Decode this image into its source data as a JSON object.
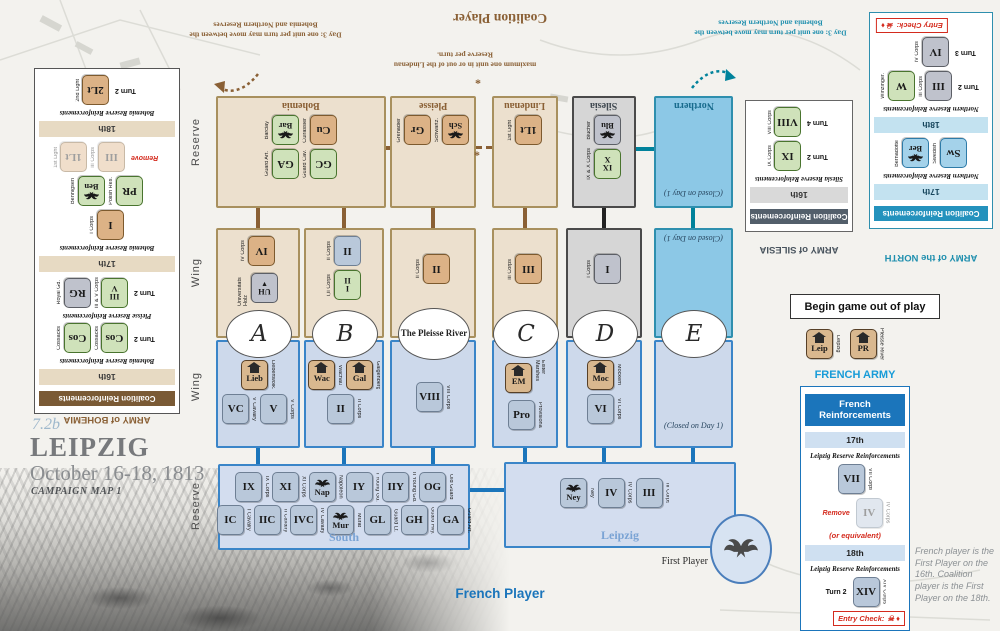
{
  "meta": {
    "code": "7.2b",
    "title": "LEIPZIG",
    "dates": "October 16-18, 1813",
    "subtitle": "CAMPAIGN MAP 1"
  },
  "players": {
    "coalition": "Coalition Player",
    "french": "French Player",
    "first": "First Player"
  },
  "notes": {
    "day3": "Day 3:  one unit per turn may move between the Bohemia and Northern Reserves",
    "lindenau_note": "maximum one unit in or out of the Lindenau Reserve per turn.",
    "asterisk": "*",
    "closed": "(Closed on Day 1)",
    "begin": "Begin game out of play",
    "first_player_note": "French player is the First Player on the 16th. Coalition player is the First Player on the 18th."
  },
  "side_labels": {
    "res_top": "Reserve",
    "wing_top": "Wing",
    "wing_bottom": "Wing",
    "res_bottom": "Reserve"
  },
  "board": {
    "titles": {
      "bohemia": "Bohemia",
      "pleisse": "Pleisse",
      "lindenau": "Lindenau",
      "silesia": "Silesia",
      "northern": "Northern"
    },
    "ovals": {
      "a": "A",
      "b": "B",
      "p": "The Pleisse River",
      "c": "C",
      "d": "D",
      "e": "E"
    },
    "south_label": "South",
    "leipzig_label": "Leipzig"
  },
  "rows": {
    "bohemia_r1": {
      "counters": [
        {
          "v": "Bar",
          "t": "green",
          "i": "eagle",
          "l": "Barclay"
        },
        {
          "v": "Cu",
          "t": "tan",
          "l": "Cuirassier"
        }
      ]
    },
    "bohemia_r2": {
      "counters": [
        {
          "v": "GA",
          "t": "green",
          "l": "Guard Art."
        },
        {
          "v": "GC",
          "t": "green",
          "l": "Guard Cav."
        }
      ]
    },
    "pleisse_r1": {
      "counters": [
        {
          "v": "Gr",
          "t": "tan",
          "l": "Grenadier"
        },
        {
          "v": "Sch",
          "t": "tan",
          "i": "eagle",
          "l": "Schwartz."
        }
      ]
    },
    "lindenau_r1": {
      "counters": [
        {
          "v": "1Lt",
          "t": "tan",
          "l": "1st Light"
        }
      ]
    },
    "silesia_r1": {
      "counters": [
        {
          "v": "Blu",
          "t": "gray",
          "i": "eagle",
          "l": "Blücher"
        },
        {
          "v": "IX|X",
          "t": "green",
          "l": "IX & X Corps"
        }
      ]
    },
    "cwA_r1": {
      "counters": [
        {
          "v": "IV",
          "t": "tan",
          "l": "IV Corps"
        }
      ]
    },
    "cwA_r2": {
      "counters": [
        {
          "v": "UH",
          "t": "gray",
          "i": "down",
          "l": "Universitäts Holz"
        }
      ]
    },
    "cwB_r1": {
      "counters": [
        {
          "v": "II",
          "t": "french",
          "l": "II Corps"
        }
      ]
    },
    "cwB_r2": {
      "counters": [
        {
          "v": "I|II",
          "t": "green",
          "l": "I,II Corps"
        }
      ]
    },
    "cwP_r1": {
      "counters": [
        {
          "v": "II",
          "t": "tan",
          "l": "II Corps"
        }
      ]
    },
    "cwC_r1": {
      "counters": [
        {
          "v": "III",
          "t": "tan",
          "l": "III Corps"
        }
      ]
    },
    "cwD_r1": {
      "counters": [
        {
          "v": "I",
          "t": "gray",
          "l": "I Corps"
        }
      ]
    },
    "fwA_r1": {
      "counters": [
        {
          "v": "Lieb",
          "t": "obj",
          "i": "house",
          "l": "Liebertwolk."
        }
      ]
    },
    "fwA_r2": {
      "counters": [
        {
          "v": "VC",
          "t": "french",
          "l": "V Cavalry"
        },
        {
          "v": "V",
          "t": "french",
          "l": "V Corps"
        }
      ]
    },
    "fwB_r1": {
      "counters": [
        {
          "v": "Wac",
          "t": "obj",
          "i": "house",
          "l": "Wachau"
        },
        {
          "v": "Gal",
          "t": "obj",
          "i": "house",
          "l": "Galgenberg"
        }
      ]
    },
    "fwB_r2": {
      "counters": [
        {
          "v": "II",
          "t": "french",
          "l": "II Corps"
        }
      ]
    },
    "fwP_r1": {
      "counters": [
        {
          "v": "VIII",
          "t": "french",
          "l": "VIII Corps"
        }
      ]
    },
    "fwC_r1": {
      "counters": [
        {
          "v": "EM",
          "t": "obj",
          "i": "house",
          "l": "Elster Marshes"
        }
      ]
    },
    "fwC_r2": {
      "counters": [
        {
          "v": "Pro",
          "t": "french",
          "l": "Provisional"
        }
      ]
    },
    "fwD_r1": {
      "counters": [
        {
          "v": "Moc",
          "t": "obj",
          "i": "house",
          "l": "Mockern"
        }
      ]
    },
    "fwD_r2": {
      "counters": [
        {
          "v": "VI",
          "t": "french",
          "l": "VI Corps"
        }
      ]
    },
    "south_r1": {
      "counters": [
        {
          "v": "IX",
          "t": "french",
          "l": "IX Corps"
        },
        {
          "v": "XI",
          "t": "french",
          "l": "XI Corps"
        },
        {
          "v": "Nap",
          "t": "french",
          "i": "eagle",
          "l": "Napoleon"
        },
        {
          "v": "IY",
          "t": "french",
          "l": "I Young Gd."
        },
        {
          "v": "IIY",
          "t": "french",
          "l": "II Young Gd."
        },
        {
          "v": "OG",
          "t": "french",
          "l": "Old Guard"
        }
      ]
    },
    "south_r2": {
      "counters": [
        {
          "v": "IC",
          "t": "french",
          "l": "I Cavalry"
        },
        {
          "v": "IIC",
          "t": "french",
          "l": "II Cavalry"
        },
        {
          "v": "IVC",
          "t": "french",
          "l": "IV Cavalry"
        },
        {
          "v": "Mur",
          "t": "french",
          "i": "eagle",
          "l": "Murat"
        },
        {
          "v": "GL",
          "t": "french",
          "l": "Guard Lt."
        },
        {
          "v": "GH",
          "t": "french",
          "l": "Guard Hvy."
        },
        {
          "v": "GA",
          "t": "french",
          "l": "Guard Art."
        }
      ]
    },
    "leipzig_r1": {
      "counters": [
        {
          "v": "Ney",
          "t": "french",
          "i": "eagle",
          "l": "Ney"
        },
        {
          "v": "IV",
          "t": "french",
          "l": "IV Corps"
        },
        {
          "v": "III",
          "t": "french",
          "l": "III Corps"
        }
      ]
    },
    "oop_r1": {
      "counters": [
        {
          "v": "Leip",
          "t": "obj",
          "i": "house",
          "l": "Leipzig"
        },
        {
          "v": "PR",
          "t": "obj",
          "i": "house",
          "l": "Pleisse River"
        }
      ]
    }
  },
  "bohemia_panel": {
    "title": "ARMY of BOHEMIA",
    "header": "Coalition Reinforcements",
    "b18": "18th",
    "b17": "17th",
    "b16": "16th",
    "lbl_b": "Bohemia Reserve Reinforcements",
    "lbl_p": "Pleisse Reserve Reinforcements",
    "r18": {
      "counters": [
        {
          "v": "2Lt",
          "t": "tan",
          "l": "2nd Light"
        }
      ],
      "post": "Turn 2"
    },
    "r17a": {
      "counters": [
        {
          "v": "1Lt",
          "t": "tan",
          "l": "1st Light",
          "faded": true
        },
        {
          "v": "III",
          "t": "tan",
          "l": "III Corps",
          "faded": true
        }
      ],
      "post": "Remove",
      "post_style": "red"
    },
    "r17b": {
      "counters": [
        {
          "v": "Ben",
          "t": "green",
          "i": "eagle",
          "l": "Bennigsen"
        },
        {
          "v": "PR",
          "t": "green",
          "l": "Polish Res."
        }
      ]
    },
    "r17c": {
      "counters": [
        {
          "v": "I",
          "t": "tan",
          "l": "I Corps"
        }
      ]
    },
    "r16p": {
      "counters": [
        {
          "v": "RG",
          "t": "gray",
          "l": "Royal Gd."
        },
        {
          "v": "III|V",
          "t": "green",
          "l": "III & V Corps"
        }
      ],
      "post": "Turn 2"
    },
    "r16b": {
      "counters": [
        {
          "v": "Cos",
          "t": "green",
          "l": "Cossacks"
        },
        {
          "v": "Cos",
          "t": "green",
          "l": "Cossacks"
        }
      ],
      "post": "Turn 2"
    }
  },
  "silesia_panel": {
    "title": "ARMY of SILESIA",
    "header": "Coalition Reinforcements",
    "b16": "16th",
    "lbl": "Silesia Reserve Reinforcements",
    "r1": {
      "counters": [
        {
          "v": "VIII",
          "t": "green",
          "l": "VIII Corps"
        }
      ],
      "post": "Turn 4"
    },
    "r2": {
      "counters": [
        {
          "v": "IX",
          "t": "green",
          "l": "IX Corps"
        }
      ],
      "post": "Turn 2"
    }
  },
  "north_panel": {
    "title": "ARMY of the NORTH",
    "header": "Coalition Reinforcements",
    "b18": "18th",
    "b17": "17th",
    "lbl": "Northern Reserve Reinforcements",
    "entry": "Entry Check:",
    "entry_icons": "☠ ♦",
    "r18a": {
      "counters": [
        {
          "v": "IV",
          "t": "gray",
          "l": "IV Corps"
        }
      ],
      "post": "Turn 3"
    },
    "r18b": {
      "counters": [
        {
          "v": "W",
          "t": "green",
          "l": "Winzinger."
        },
        {
          "v": "III",
          "t": "gray",
          "l": "III Corps"
        }
      ],
      "post": "Turn 2"
    },
    "r17": {
      "counters": [
        {
          "v": "Ber",
          "t": "blue",
          "i": "eagle",
          "l": "Bernadotte"
        },
        {
          "v": "Sw",
          "t": "blue",
          "l": "Swedish"
        }
      ]
    }
  },
  "french_panel": {
    "title": "FRENCH ARMY",
    "header": "French Reinforcements",
    "b17": "17th",
    "b18": "18th",
    "lbl": "Leipzig Reserve Reinforcements",
    "entry": "Entry Check:",
    "entry_icons": "☠ ♦",
    "or_equiv": "(or equivalent)",
    "r17a": {
      "counters": [
        {
          "v": "VII",
          "t": "french",
          "l": "VII Corps"
        }
      ]
    },
    "r17b": {
      "counters": [
        {
          "v": "IV",
          "t": "french",
          "l": "IV Corps",
          "faded": true
        }
      ],
      "pre": "Remove",
      "pre_style": "red"
    },
    "r18": {
      "counters": [
        {
          "v": "XIV",
          "t": "french",
          "l": "XIV Corps"
        }
      ],
      "pre": "Turn 2"
    }
  }
}
